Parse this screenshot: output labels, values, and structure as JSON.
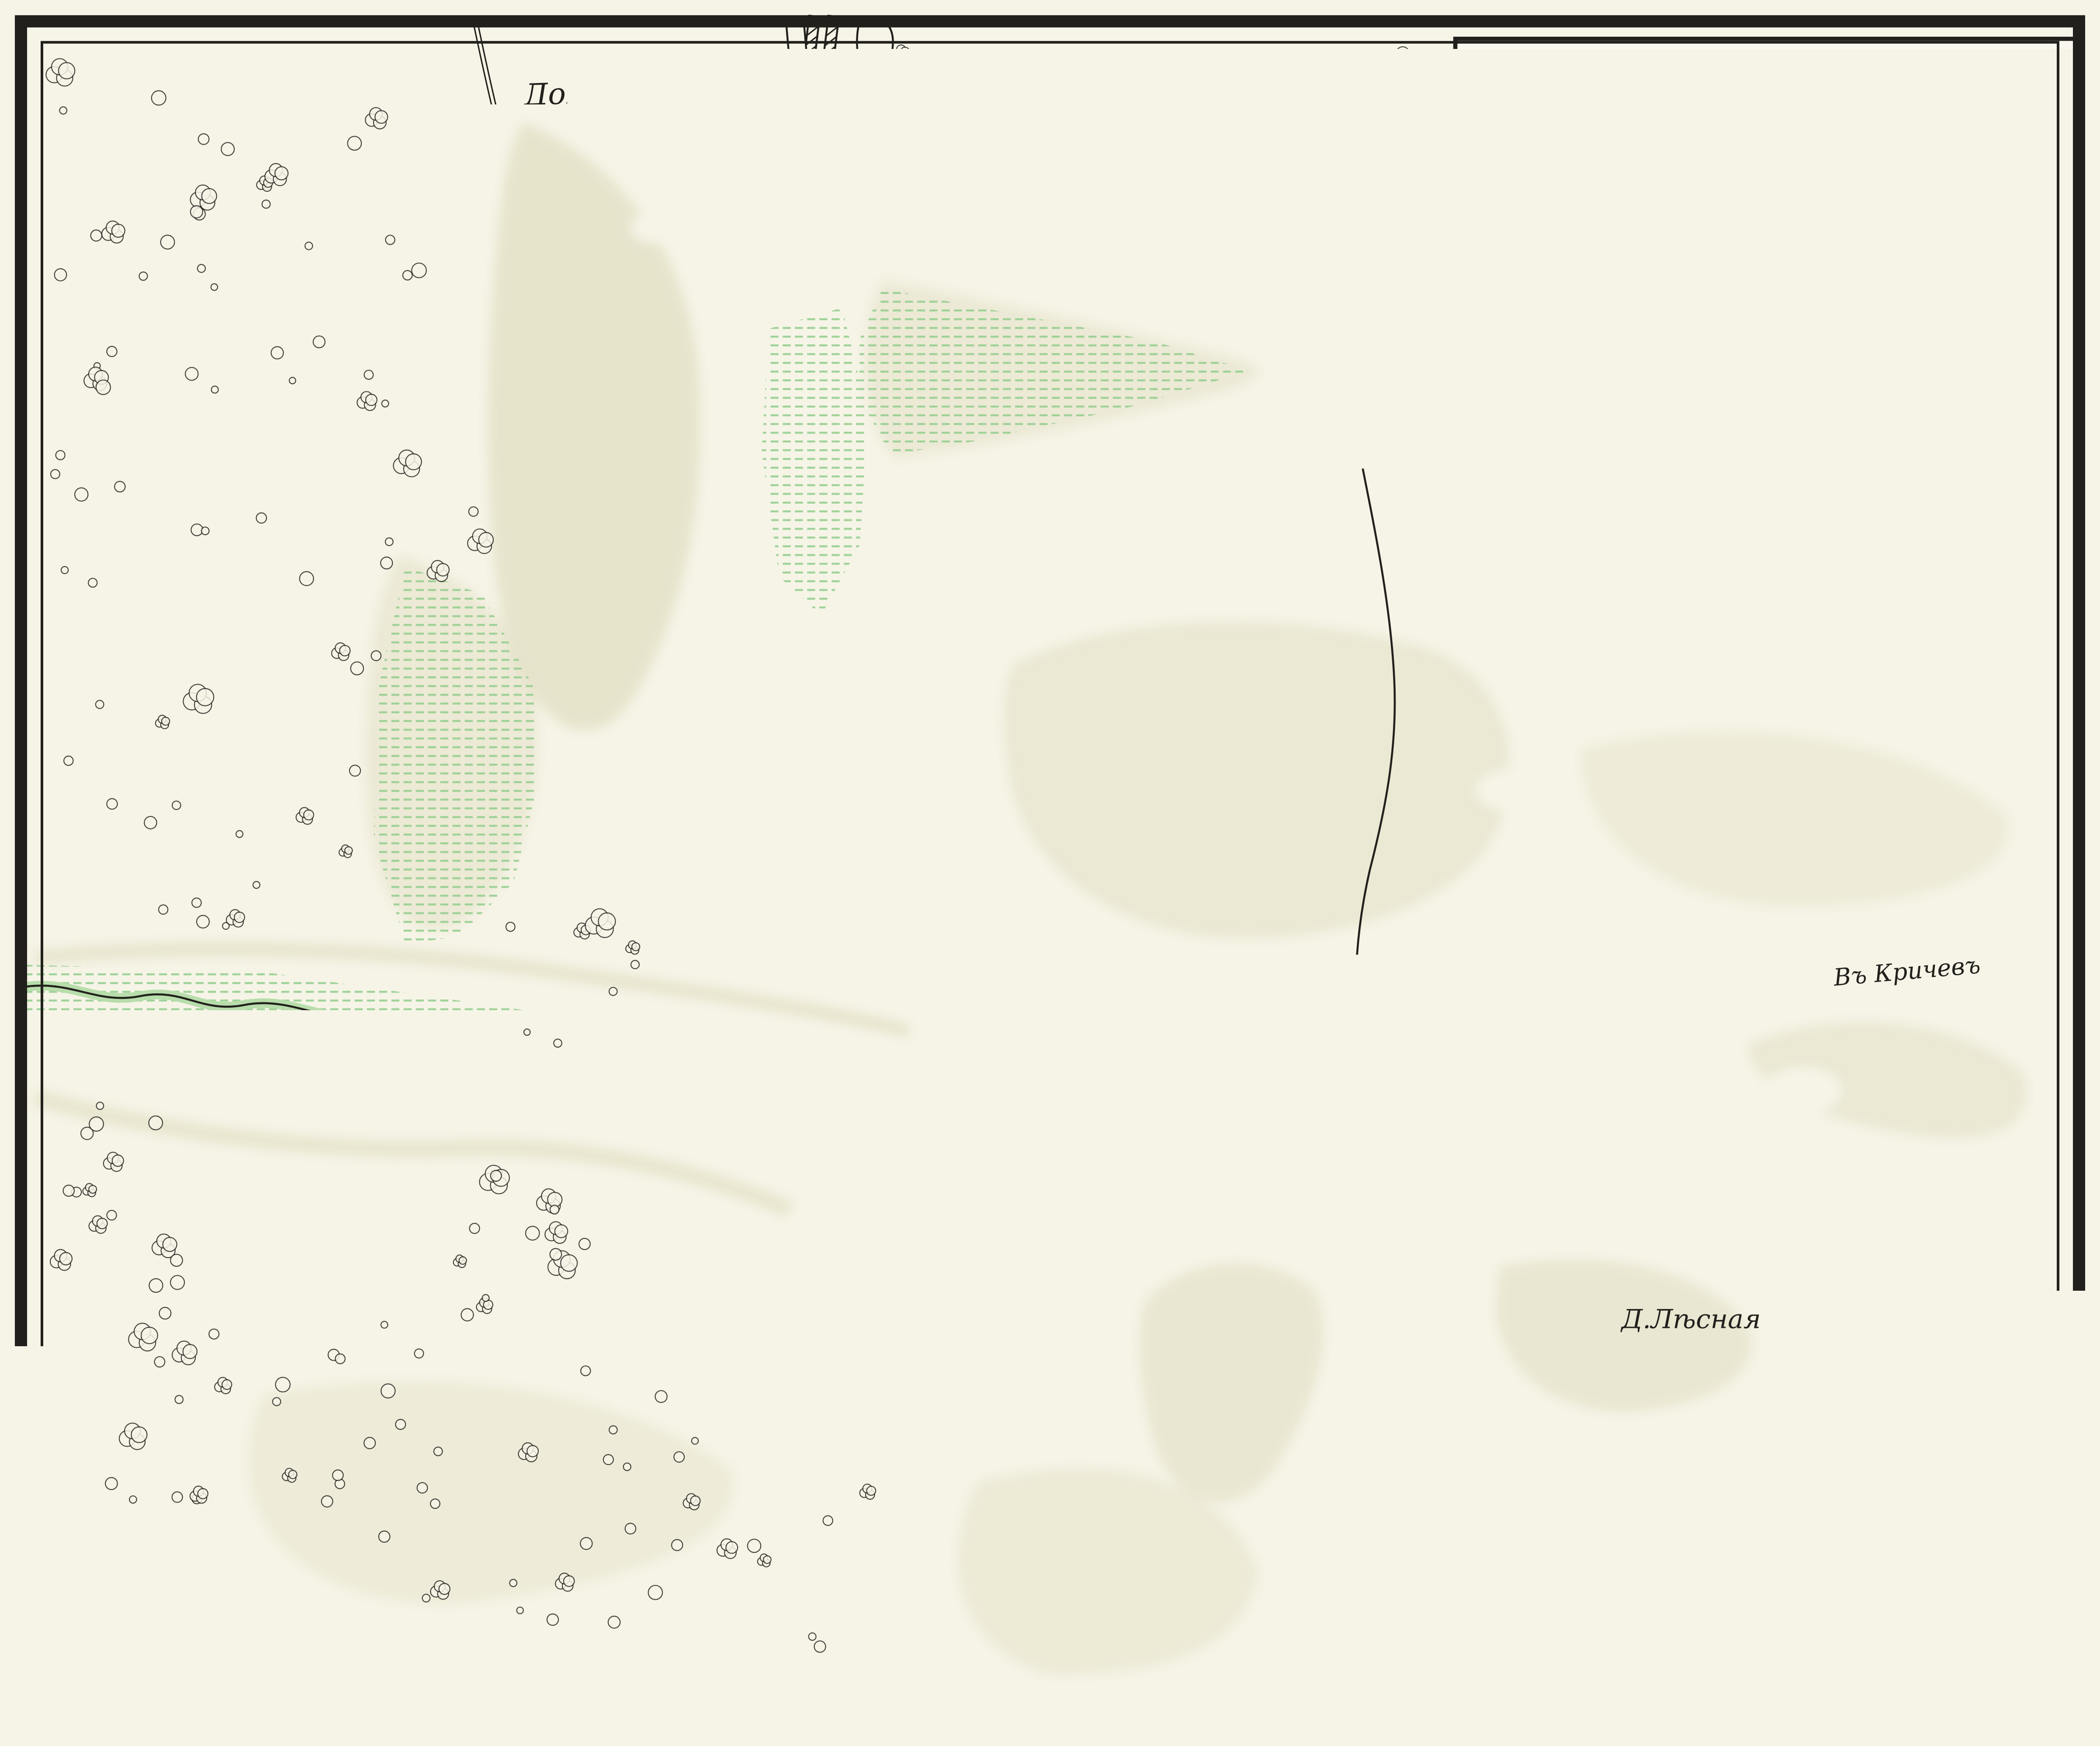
{
  "title_block": {
    "line1": "ПЛАНЪ",
    "line2": "СРАЖЕНІЯ ПРИ Д.ЛѢСНОЙ",
    "line3": "28 Сентября 1708 г.",
    "scale_label": "Масштабъ",
    "scale_tick_0": "0",
    "scale_tick_mid": "250",
    "scale_tick_end": "500 Саж."
  },
  "labels": {
    "bog": "Долгій Мохъ",
    "village": "Д.Лѣсная",
    "to_krichev": "Въ Кричевъ",
    "to_propoisk": "въ Пропоіскъ"
  },
  "legend": {
    "group_label": "Войска",
    "items": [
      {
        "label": "Русскія"
      },
      {
        "label": "Шведскія"
      }
    ]
  },
  "credit": {
    "left": "КАРТОГР. ЗАВ",
    "right": "А.ИЛЬИНА, С.П.Б"
  },
  "colors": {
    "paper": "#f6f4e7",
    "paper_bright": "#faf8ee",
    "ink": "#22201c",
    "water": "#b7ddab",
    "meadow_line": "#96cf90",
    "terrain": "#d6d1ad"
  }
}
